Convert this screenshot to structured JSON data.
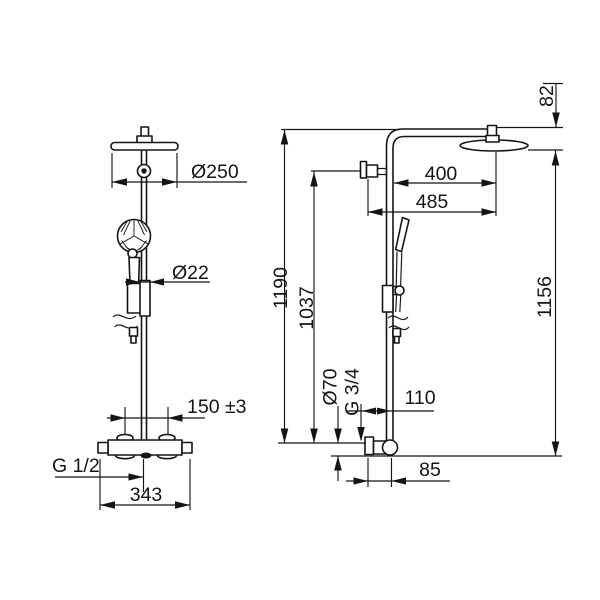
{
  "meta": {
    "drawing_type": "technical dimension drawing",
    "subject": "shower column with overhead rain shower, hand shower and thermostatic mixer",
    "background_color": "#ffffff",
    "line_color": "#141414"
  },
  "views": {
    "front": {
      "name": "front view",
      "dimensions": {
        "head_diameter": "Ø250",
        "rail_diameter": "Ø22",
        "inlet_spacing": "150 ±3",
        "inlet_thread": "G 1/2",
        "body_width": "343"
      }
    },
    "side": {
      "name": "side view",
      "dimensions": {
        "arm_drop": "82",
        "arm_reach": "400",
        "arm_reach_total": "485",
        "total_height": "1190",
        "rail_height": "1037",
        "head_height": "1156",
        "valve_diameter": "Ø70",
        "outlet_thread": "G 3/4",
        "wall_offset": "110",
        "valve_offset": "85"
      }
    }
  }
}
